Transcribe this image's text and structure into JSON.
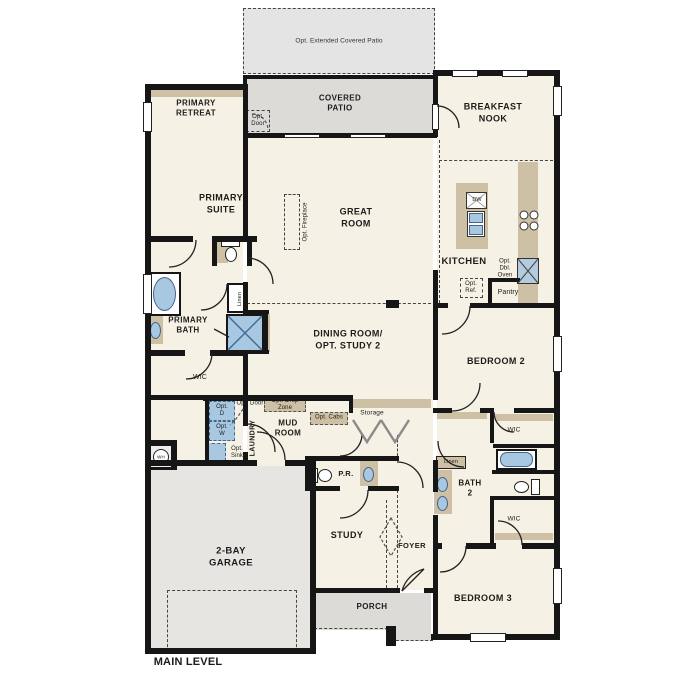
{
  "title": "MAIN LEVEL",
  "colors": {
    "wall": "#161616",
    "room_fill": "#f6f1e5",
    "patio_gray": "#dcdbd8",
    "garage_gray": "#e6e5e2",
    "counter_tan": "#cdc0a4",
    "fixture_blue": "#a8c7e0"
  },
  "labels": {
    "main_level": "MAIN LEVEL",
    "opt_extended_covered_patio": "Opt. Extended Covered Patio",
    "covered_patio": "COVERED\nPATIO",
    "opt_door_patio": "Opt.\nDoor",
    "primary_retreat": "PRIMARY\nRETREAT",
    "breakfast_nook": "BREAKFAST\nNOOK",
    "primary_suite": "PRIMARY\nSUITE",
    "great_room": "GREAT\nROOM",
    "opt_fireplace": "Opt. Fireplace",
    "kitchen": "KITCHEN",
    "dw": "DW",
    "opt_ref": "Opt.\nRef.",
    "opt_dbl_oven": "Opt.\nDbl.\nOven",
    "pantry": "Pantry",
    "primary_bath": "PRIMARY\nBATH",
    "linen_primary": "Linen",
    "seat": "Seat",
    "wic_primary": "WIC",
    "dining_room": "DINING ROOM/\nOPT. STUDY 2",
    "bedroom_2": "BEDROOM 2",
    "opt_d": "Opt.\nD",
    "opt_w": "Opt.\nW",
    "opt_door_laundry": "Opt. Door",
    "laundry": "LAUNDRY",
    "opt_drop_zone": "Opt. Drop\nZone",
    "mud_room": "MUD\nROOM",
    "opt_cabs": "Opt. Cabs",
    "storage": "Storage",
    "opt_sink": "Opt.\nSink",
    "wh": "WH",
    "powder_room": "P.R.",
    "bath_2": "BATH\n2",
    "linen_bath2": "Linen",
    "wic_bedroom2": "WIC",
    "wic_bedroom3": "WIC",
    "garage": "2-BAY\nGARAGE",
    "study": "STUDY",
    "foyer": "FOYER",
    "bedroom_3": "BEDROOM 3",
    "porch": "PORCH"
  }
}
